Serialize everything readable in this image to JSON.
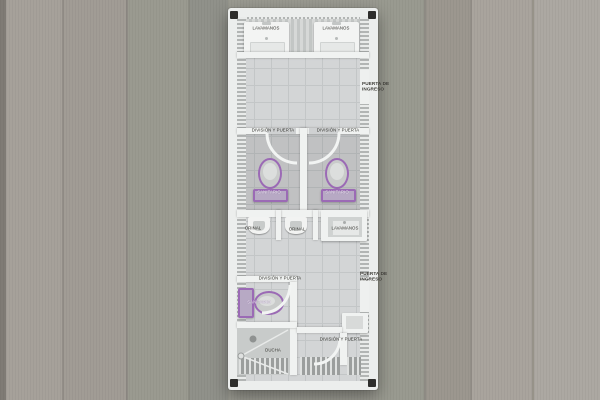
{
  "colors": {
    "accent_purple": "#9b6ab5",
    "wall_white": "#f0f2f1",
    "tile_gray": "#d3d5d6",
    "background_wood": "#a19c95"
  },
  "plan": {
    "top_sinks": {
      "left_label": "LAVAMANOS",
      "right_label": "LAVAMANOS"
    },
    "entrance_top": {
      "line1": "PUERTA DE",
      "line2": "INGRESO"
    },
    "entrance_bottom": {
      "line1": "PUERTA DE",
      "line2": "INGRESO"
    },
    "stall_left": {
      "division": "DIVISIÓN Y PUERTA",
      "toilet": "SANITARIO"
    },
    "stall_right": {
      "division": "DIVISIÓN Y PUERTA",
      "toilet": "SANITARIO"
    },
    "urinal_left": {
      "label": "ORINAL"
    },
    "urinal_right": {
      "label": "ORINAL"
    },
    "mid_sink": {
      "label": "LAVAMANOS"
    },
    "toilet_room": {
      "division": "DIVISIÓN Y PUERTA",
      "toilet": "SANITARIO"
    },
    "shower": {
      "label": "DUCHA"
    },
    "bottom_stall": {
      "division": "DIVISIÓN Y PUERTA"
    }
  }
}
